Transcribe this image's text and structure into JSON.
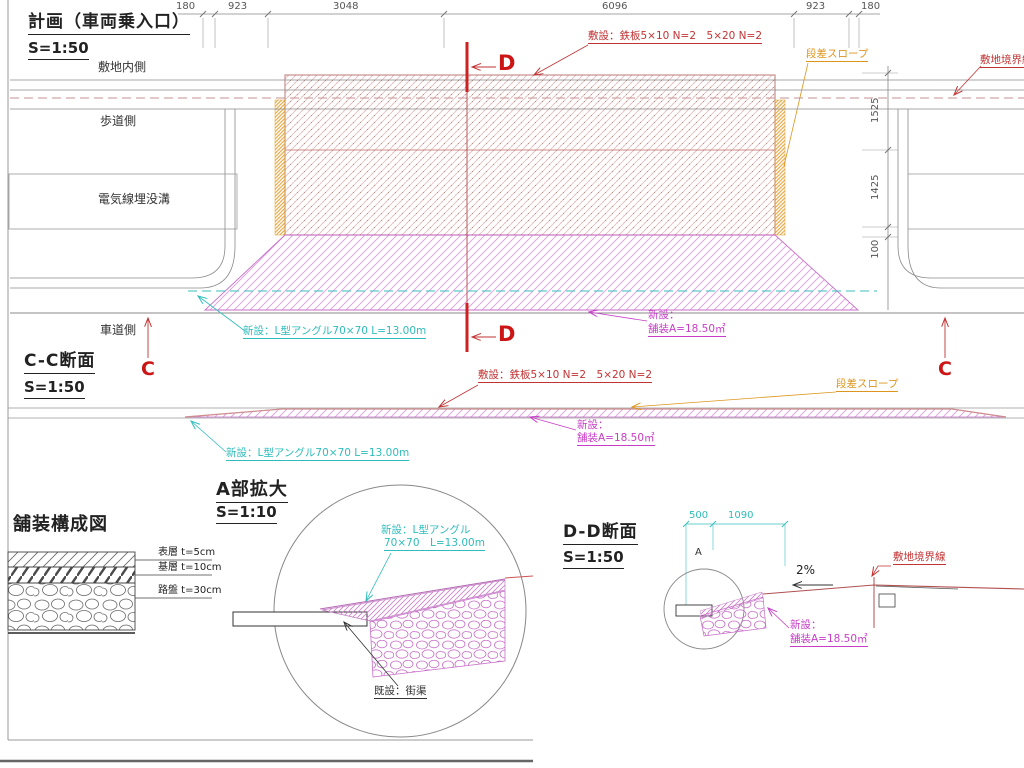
{
  "plan": {
    "title": "計画（車両乗入口）",
    "scale": "S=1:50",
    "dims_top": [
      "180",
      "923",
      "3048",
      "6096",
      "923",
      "180"
    ],
    "dims_right": [
      "1525",
      "1425",
      "100"
    ],
    "area_labels": {
      "site_inner": "敷地内側",
      "sidewalk": "歩道側",
      "electric_trench": "電気線埋没溝",
      "roadway": "車道側"
    },
    "notes": {
      "steel_plate": "敷設：鉄板5×10 N=2　5×20 N=2",
      "step_slope": "段差スロープ",
      "site_boundary": "敷地境界線",
      "l_angle": "新設：L型アングル70×70 L=13.00m",
      "new_paving_line1": "新設：",
      "new_paving_line2": "舗装A=18.50㎡"
    },
    "section_marks": {
      "c": "C",
      "d": "D"
    }
  },
  "cc_section": {
    "title": "C-C断面",
    "scale": "S=1:50",
    "notes": {
      "steel_plate": "敷設：鉄板5×10 N=2　5×20 N=2",
      "step_slope": "段差スロープ",
      "l_angle": "新設：L型アングル70×70 L=13.00m",
      "new_paving_line1": "新設：",
      "new_paving_line2": "舗装A=18.50㎡"
    }
  },
  "pavement_fig": {
    "title": "舗装構成図",
    "layers": [
      "表層 t=5cm",
      "基層 t=10cm",
      "路盤 t=30cm"
    ]
  },
  "detail_a": {
    "title": "A部拡大",
    "scale": "S=1:10",
    "notes": {
      "l_angle_line1": "新設：L型アングル",
      "l_angle_line2": "70×70　L=13.00m",
      "existing_gutter": "既設：街渠"
    }
  },
  "dd_section": {
    "title": "D-D断面",
    "scale": "S=1:50",
    "dims": [
      "500",
      "1090"
    ],
    "point_label": "A",
    "grade": "2%",
    "notes": {
      "site_boundary": "敷地境界線",
      "new_paving_line1": "新設：",
      "new_paving_line2": "舗装A=18.50㎡"
    }
  },
  "colors": {
    "annotation_red": "#c23333",
    "annotation_cyan": "#2fbcbc",
    "annotation_magenta": "#c83cc8",
    "annotation_orange": "#dd951e",
    "steel_hatch": "#e3b9b9",
    "line_gray": "#8a8a8a"
  }
}
